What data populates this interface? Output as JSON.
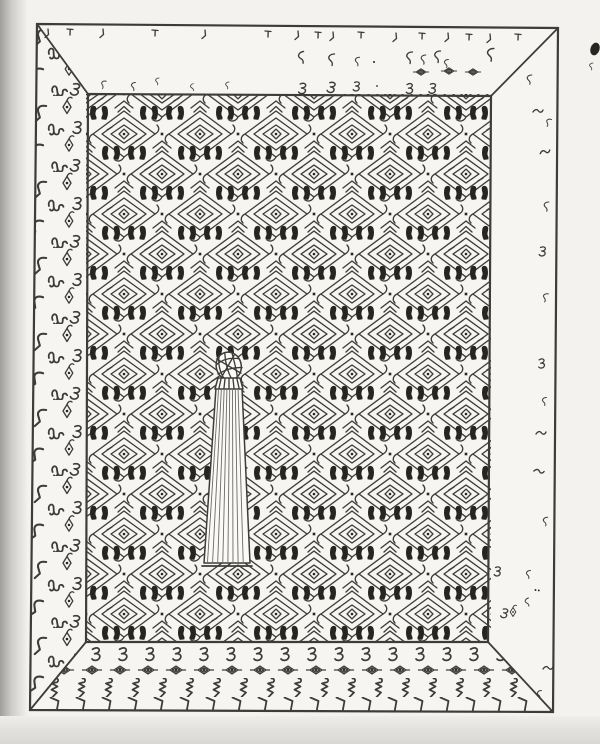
{
  "figure": {
    "name": "ink-perspective-drawing-of-decorated-chamber-with-central-fluted-column",
    "panels": {
      "back_wall": "dense nested-diamond lattice with chevron caps, hook tips and solid double-hook accents",
      "left_wall": "columns of hook, double-curl squiggle, eye-diamond and curl motifs",
      "right_wall": "sparse small squiggle and dot motifs",
      "ceiling": "hanging tick marks along top edge, scattered squiggles and three small eye motifs",
      "floor_rows": [
        "curl-squiggle row",
        "eye-diamond row",
        "zigzag-figure row",
        "hook row"
      ],
      "center_object": "tapered fluted column with ribbed knob cap"
    },
    "motif_names": [
      "hook-icon",
      "squiggle-icon",
      "eye-diamond-icon",
      "curl-icon",
      "zigzag-figure-icon",
      "boots-accent-icon",
      "diamond-lattice-icon",
      "tick-icon"
    ]
  },
  "colors": {
    "ink": "#3d3c3a",
    "ink_bold": "#26251f",
    "paper": "#f6f5f1",
    "page": "#f3f2ee",
    "column_fill": "#fbfaf7"
  }
}
